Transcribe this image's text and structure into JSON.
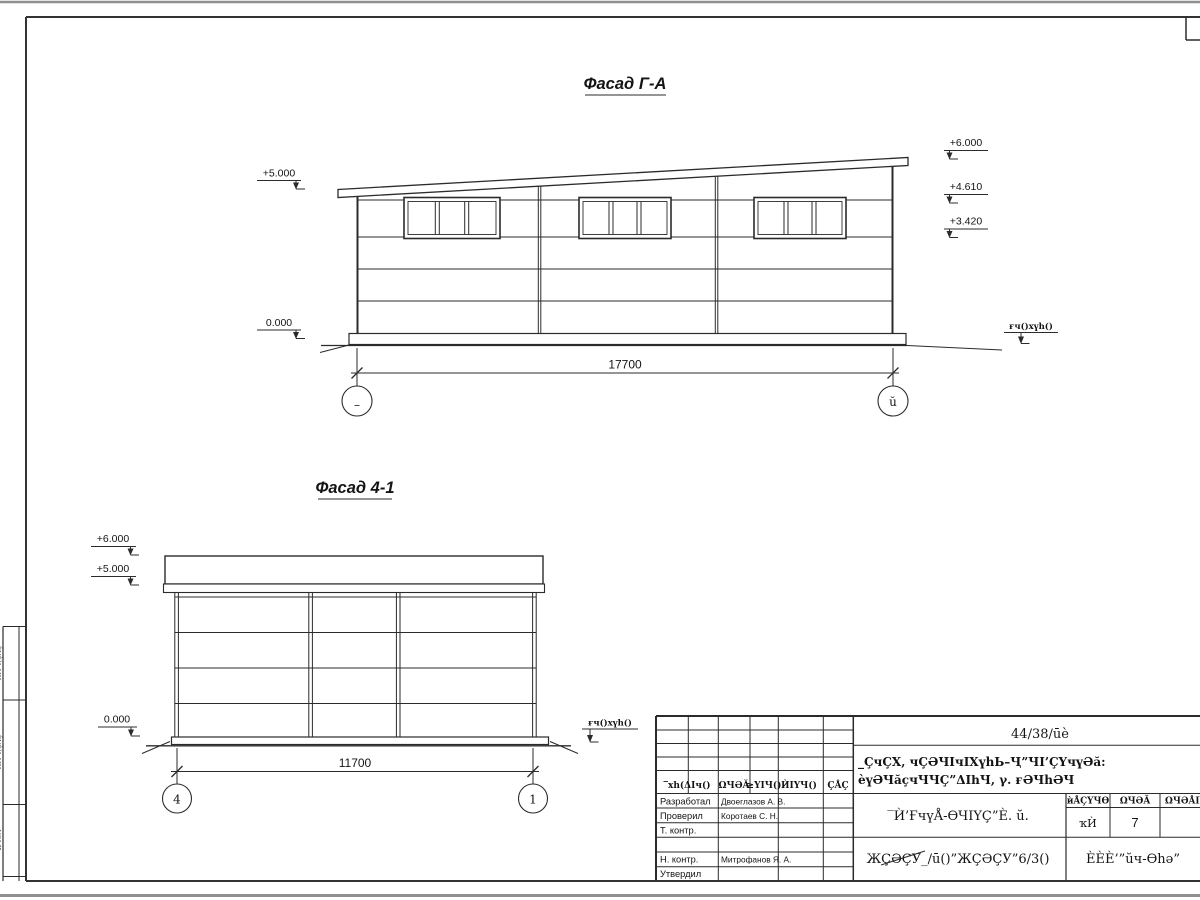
{
  "facade_ga": {
    "title": "Фасад Г-А",
    "dim_label": "17700",
    "axis_left_label": "–",
    "axis_right_label": "ŭ",
    "elev_plus5": "+5.000",
    "elev_zero": "0.000",
    "elev_plus6": "+6.000",
    "elev_plus461": "+4.610",
    "elev_plus342": "+3.420",
    "ground_level_label": "ғч()xүh()"
  },
  "facade_41": {
    "title": "Фасад 4-1",
    "dim_label": "11700",
    "axis_left_label": "4",
    "axis_right_label": "1",
    "elev_plus6": "+6.000",
    "elev_plus5": "+5.000",
    "elev_zero": "0.000",
    "ground_level_label": "ғч()xүh()"
  },
  "title_block": {
    "doc_no": "44/38/ūè",
    "subject_line1": "_ÇчÇХ, чÇƏЧIчIХүhЬ–Ҷ”ЧI’ÇҮчүƏă:",
    "subject_line2": "èүƏЧăçчЧЧÇ”ΔIһЧ, γ. ғƏЧhƏЧ",
    "designation": "‾Ѝ’ҒчүÅ-ѲЧIҮÇ”È. ŭ.",
    "order_no": "ЖÇƏÇУ_/ū()”ЖÇƏÇУ”6/3()",
    "company": "ÈÈÈ’”ŭч-Ѳhə”",
    "col_header_left": "‾хh(ΔIч()",
    "col_header_list": "ΩЧƏĂ",
    "col_header_ndoc": "≥ҮIЧ()",
    "col_header_podp": "ЍIҮЧ()",
    "col_header_data": "ÇÅÇ",
    "stage_header": "ѝÅÇҮЧѲ",
    "sheet_header": "ΩЧƏĂ",
    "sheets_header": "ΩЧƏÅIҮ",
    "stage_value": "ҡЍ",
    "sheet_value": "7",
    "rows": [
      {
        "label": "Разработал",
        "person": "Двоеглазов А. В."
      },
      {
        "label": "Проверил",
        "person": "Коротаев С. Н."
      },
      {
        "label": "Т. контр.",
        "person": ""
      },
      {
        "label": "",
        "person": ""
      },
      {
        "label": "Н. контр.",
        "person": "Митрофанов Я. А."
      },
      {
        "label": "Утвердил",
        "person": ""
      }
    ]
  },
  "margin_stamps": {
    "s1": "ЍIҮЧ(ÇÅÇ",
    "s2": "ЍIҮЧ(ÇÅÇ",
    "s3": "ΩЧƏĂ"
  }
}
